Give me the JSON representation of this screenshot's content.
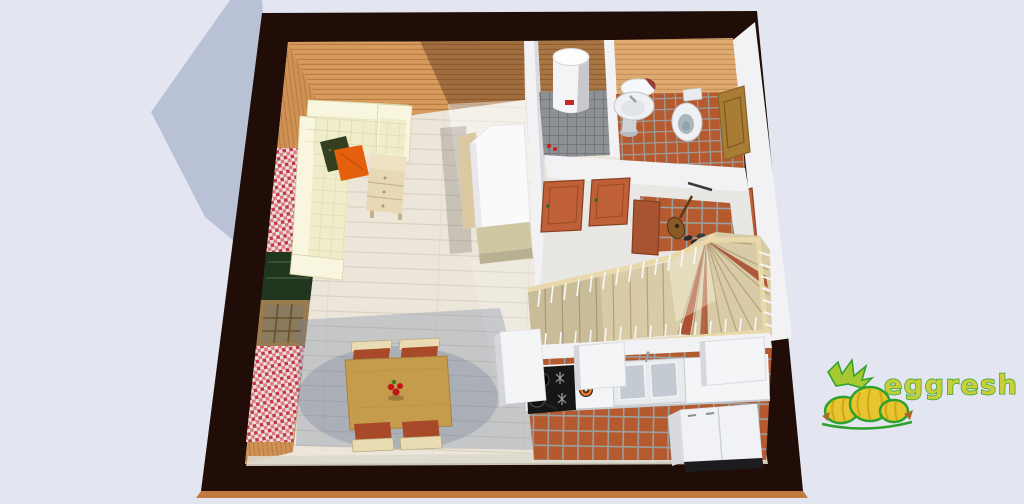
{
  "scene": {
    "type": "3d-floor-plan-render",
    "rooms": [
      "living-room",
      "dining-area",
      "utility-room",
      "bathroom",
      "hallway",
      "staircase",
      "kitchen"
    ],
    "objects": [
      "corner-sofa",
      "orange-pillow",
      "dark-pillow",
      "side-chest",
      "wardrobe",
      "dining-table",
      "four-chairs",
      "flower-vase",
      "wall-rug-upper",
      "planter-box",
      "window",
      "wall-rug-lower",
      "water-heater",
      "pedestal-sink",
      "mirror",
      "toilet",
      "bathroom-door",
      "hall-door-1",
      "hall-door-2",
      "hall-cabinet-door",
      "front-door",
      "coat-rack",
      "guitar",
      "shoes",
      "winder-staircase",
      "wood-handrail",
      "white-balusters",
      "kitchen-counter",
      "stove",
      "pan",
      "gas-burner-flame",
      "double-sink",
      "wall-cabinet-left",
      "wall-cabinet-right",
      "tall-cabinet",
      "refrigerator"
    ]
  },
  "logo": {
    "text": "eggresh"
  },
  "colors": {
    "bg": "#e3e6f1",
    "shadow": "#b9c1d7",
    "wall_dark": "#200d07",
    "base_strip": "#c07a3e",
    "wood_wall": "#d79b5d",
    "wood_wall_line": "#b87b41",
    "wood_shade": "rgba(70,34,14,0.38)",
    "left_wall": "#cf9154",
    "floor_wood": "#ebe6d9",
    "floor_line": "#d8d0bf",
    "floor_shade": "rgba(110,125,160,0.30)",
    "sun_white": "rgba(255,255,255,0.45)",
    "tile": "#b5592f",
    "tile_grout": "#9aa09e",
    "gray_tile": "#8d9095",
    "gray_tile_line": "#74777c",
    "white_wall": "#f2f2f5",
    "white_wall_shade": "#d9dade",
    "hall_floor": "#e9e7e3",
    "sofa": "#f0edcb",
    "sofa_light": "#f8f6de",
    "sofa_shade": "#d9d5ab",
    "pillow_orange": "#e5600d",
    "pillow_dark": "#333f20",
    "chest": "#e8d9b6",
    "chest_line": "#c8b68c",
    "chest_top": "#efe2c2",
    "table_wood": "#c59b4c",
    "table_edge": "#a8803a",
    "chair_frame": "#eadcb2",
    "chair_seat": "#a8492a",
    "vase_red": "#c01818",
    "vase_green": "#3a7a2a",
    "wardrobe_body": "#fafafb",
    "wardrobe_back": "#dcc9a2",
    "wardrobe_front": "#cfc6a2",
    "door_orange": "#c06038",
    "door_orange_dark": "#9a4a28",
    "door_brown": "#a87c35",
    "door_brown_dark": "#7a581f",
    "stair_wood": "#d9cba5",
    "stair_line": "#b2a37c",
    "stair_red": "#a33c20",
    "rail_wood": "#e9d8aa",
    "baluster": "#f6f6f8",
    "counter": "#f4f5f7",
    "counter_edge": "#c6c9ce",
    "sink_steel": "#c3cad2",
    "stove_black": "#161616",
    "burner_gray": "#9aa0a6",
    "flame": "#f07820",
    "fridge": "#f0f2f5",
    "fridge_side": "#d8dadf",
    "heater": "#f4f4f6",
    "heater_shade": "#c9c9cd",
    "heater_label": "#cc2222",
    "rug_base": "#ecdfdc",
    "rug_red": "#c43a44",
    "rug_pink": "#d87a80",
    "planter_green": "#20361f",
    "window_frame": "#9a7b4e",
    "window_pane": "#8a7a5e",
    "window_grid": "#6b5128",
    "mirror_red": "#8a2020",
    "fixture_white": "#eef0f3",
    "fixture_inner": "#a9b6ba",
    "logo_green": "#2da12d",
    "logo_yellow": "#e7c531",
    "logo_fill": "#c9cf3c",
    "logo_leaf": "#a6c832",
    "logo_stem": "#a86a28"
  }
}
